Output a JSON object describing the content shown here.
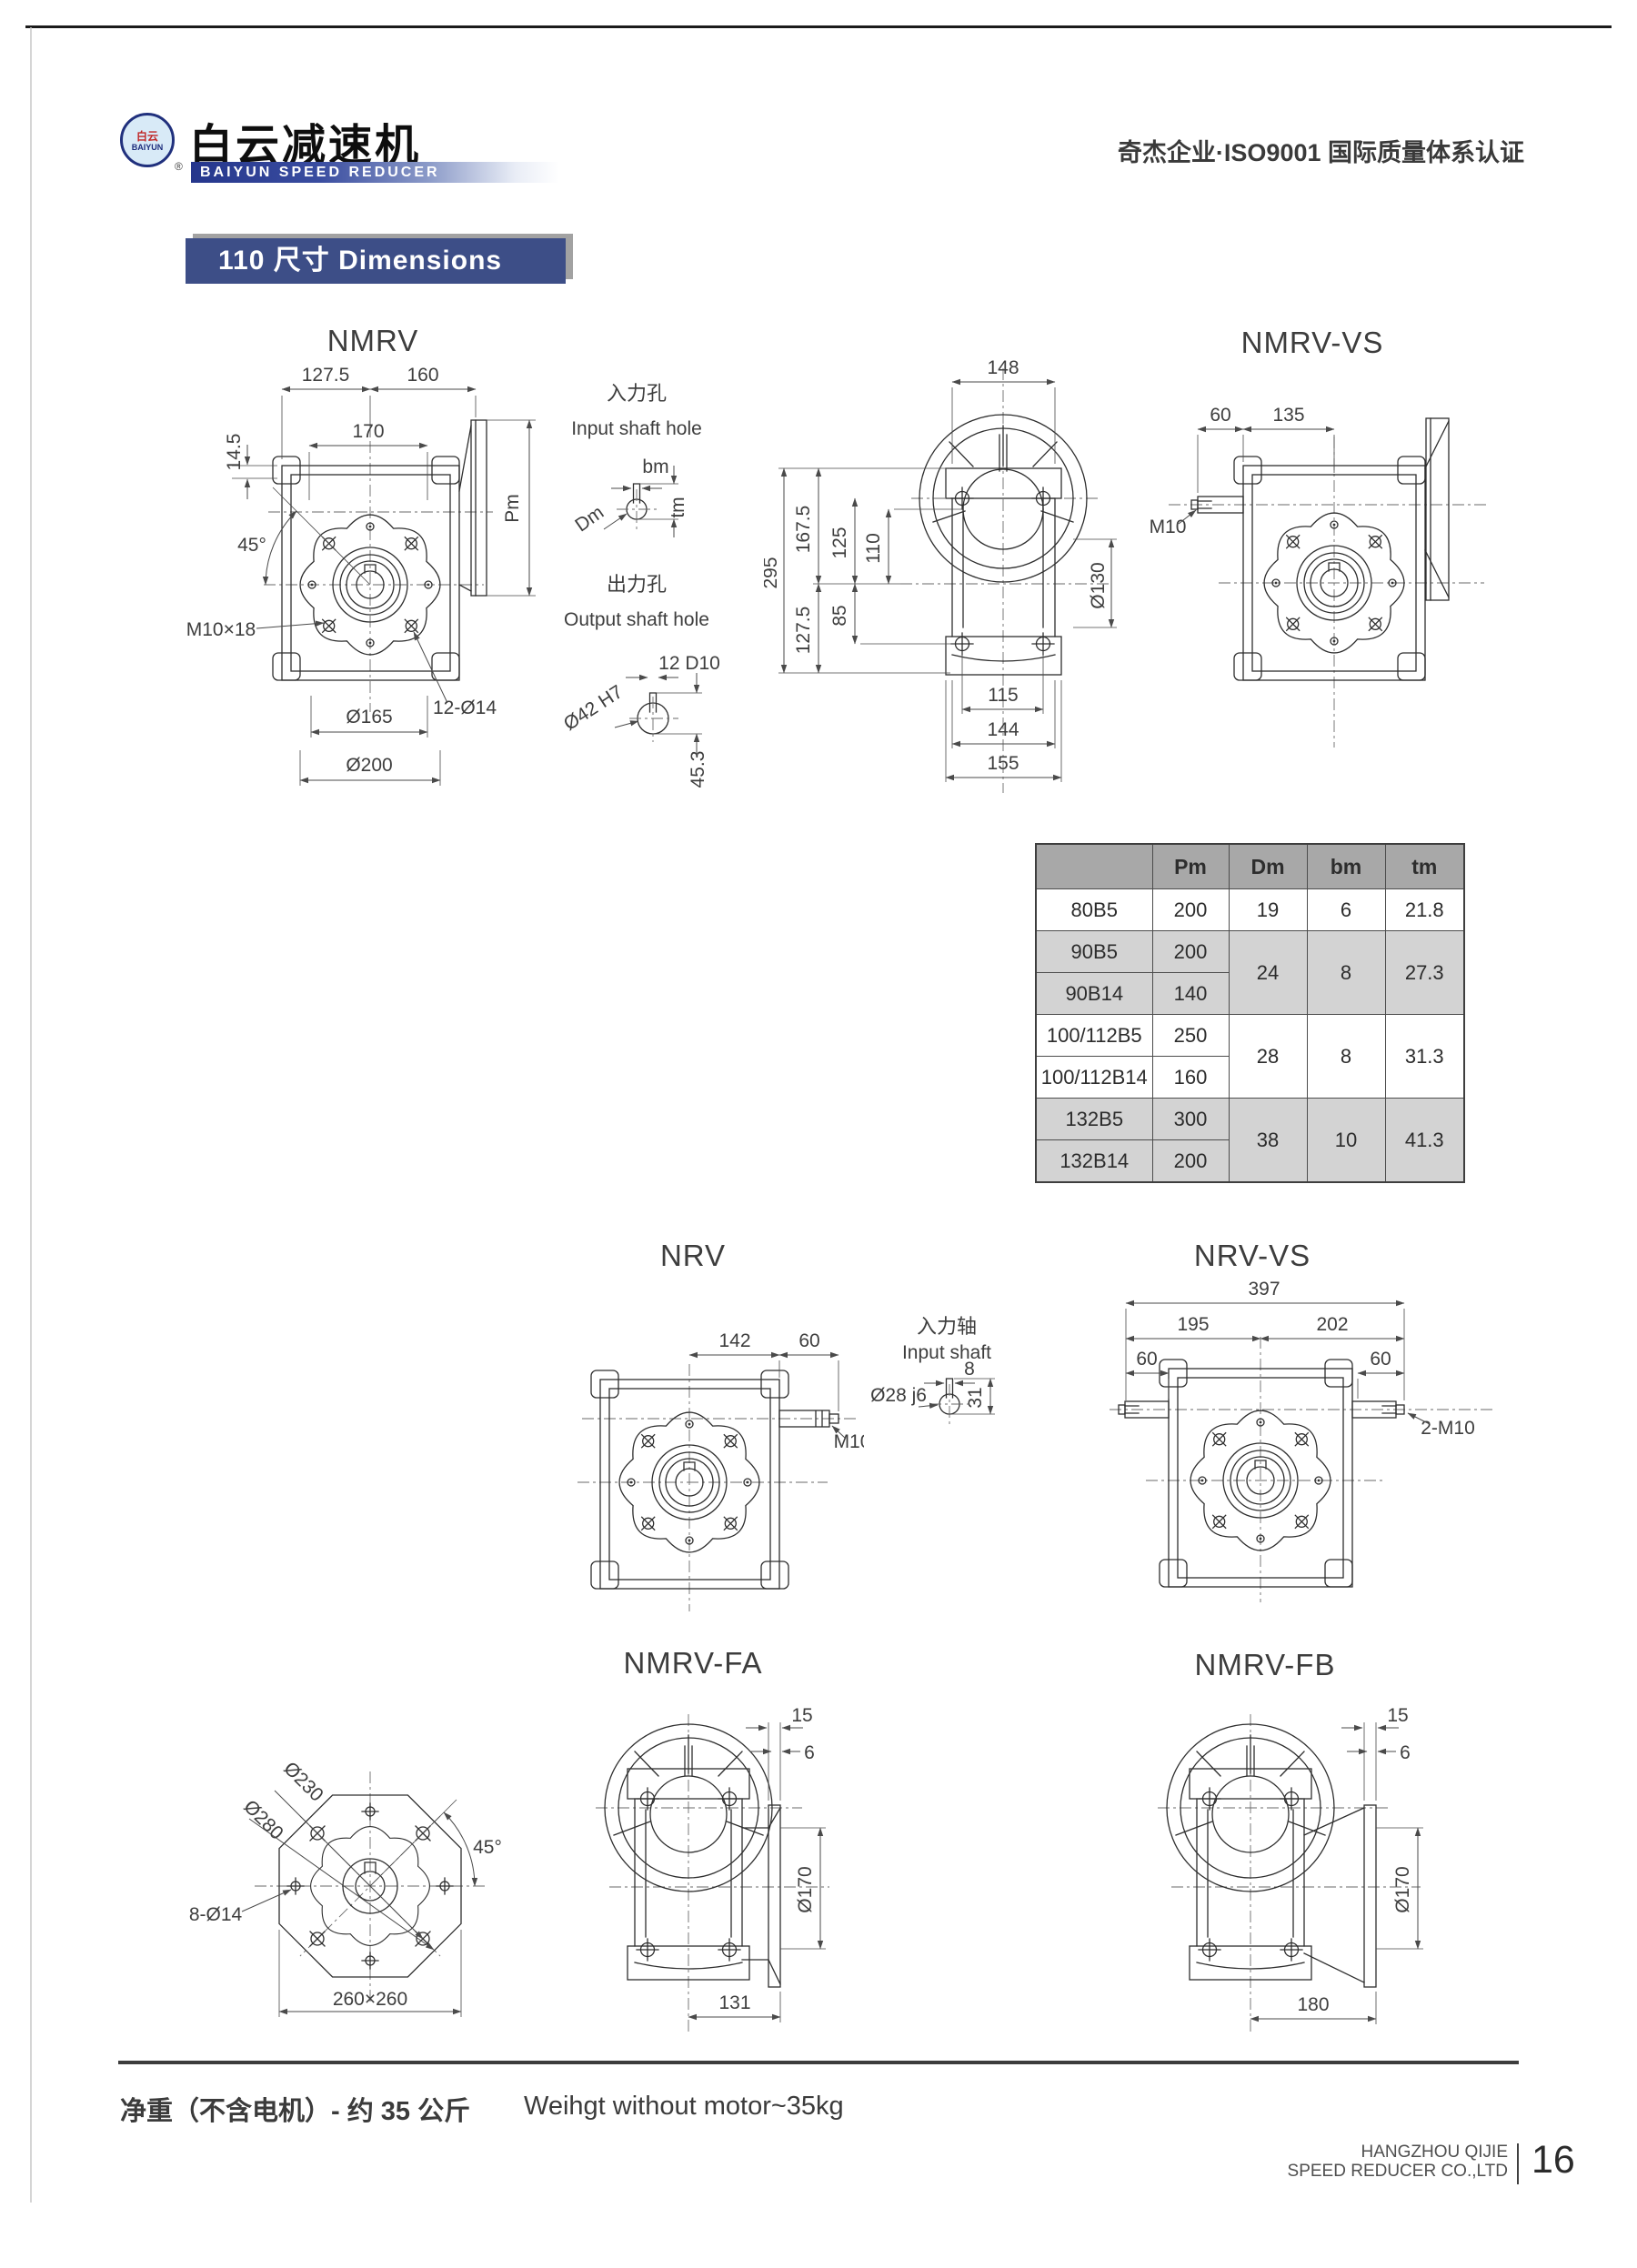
{
  "header": {
    "logo": {
      "emblem_line1": "白云",
      "emblem_line2": "BAIYUN",
      "brand_cn": "白云减速机",
      "brand_en": "BAIYUN SPEED REDUCER",
      "registered_mark": "®"
    },
    "certification": "奇杰企业·ISO9001 国际质量体系认证"
  },
  "section": {
    "title": "110 尺寸 Dimensions"
  },
  "figures": {
    "nmrv": {
      "title": "NMRV",
      "d1": "127.5",
      "d2": "160",
      "d3": "170",
      "d4": "14.5",
      "angle": "45°",
      "thread": "M10×18",
      "bolt_note": "12-Ø14",
      "dia1": "Ø165",
      "dia2": "Ø200",
      "pm": "Pm"
    },
    "input_hole": {
      "title_cn": "入力孔",
      "title_en": "Input shaft hole",
      "bm": "bm",
      "dm": "Dm",
      "tm": "tm"
    },
    "output_hole": {
      "title_cn": "出力孔",
      "title_en": "Output shaft hole",
      "key": "12 D10",
      "bore": "Ø42 H7",
      "depth": "45.3"
    },
    "nmrv_side": {
      "d148": "148",
      "d295": "295",
      "d167": "167.5",
      "d127": "127.5",
      "d125": "125",
      "d110": "110",
      "d85": "85",
      "dia130": "Ø130",
      "d115": "115",
      "d144": "144",
      "d155": "155"
    },
    "nmrv_vs": {
      "title": "NMRV-VS",
      "d60": "60",
      "d135": "135",
      "thread": "M10"
    },
    "nrv": {
      "title": "NRV",
      "d142": "142",
      "d60": "60",
      "thread": "M10"
    },
    "input_shaft": {
      "title_cn": "入力轴",
      "title_en": "Input shaft",
      "dia": "Ø28 j6",
      "d8": "8",
      "d31": "31"
    },
    "nrv_vs": {
      "title": "NRV-VS",
      "d397": "397",
      "d195": "195",
      "d202": "202",
      "d60l": "60",
      "d60r": "60",
      "thread": "2-M10"
    },
    "flange": {
      "dia230": "Ø230",
      "dia280": "Ø280",
      "angle": "45°",
      "holes": "8-Ø14",
      "square": "260×260"
    },
    "nmrv_fa": {
      "title": "NMRV-FA",
      "d15": "15",
      "d6": "6",
      "dia170": "Ø170",
      "d131": "131"
    },
    "nmrv_fb": {
      "title": "NMRV-FB",
      "d15": "15",
      "d6": "6",
      "dia170": "Ø170",
      "d180": "180"
    }
  },
  "table": {
    "headers": {
      "model": "",
      "pm": "Pm",
      "dm": "Dm",
      "bm": "bm",
      "tm": "tm"
    },
    "groups": [
      {
        "rows": [
          {
            "model": "80B5",
            "pm": "200"
          }
        ],
        "dm": "19",
        "bm": "6",
        "tm": "21.8"
      },
      {
        "rows": [
          {
            "model": "90B5",
            "pm": "200"
          },
          {
            "model": "90B14",
            "pm": "140"
          }
        ],
        "dm": "24",
        "bm": "8",
        "tm": "27.3"
      },
      {
        "rows": [
          {
            "model": "100/112B5",
            "pm": "250"
          },
          {
            "model": "100/112B14",
            "pm": "160"
          }
        ],
        "dm": "28",
        "bm": "8",
        "tm": "31.3"
      },
      {
        "rows": [
          {
            "model": "132B5",
            "pm": "300"
          },
          {
            "model": "132B14",
            "pm": "200"
          }
        ],
        "dm": "38",
        "bm": "10",
        "tm": "41.3"
      }
    ]
  },
  "footer": {
    "weight_cn": "净重（不含电机）- 约 35 公斤",
    "weight_en": "Weihgt without motor~35kg",
    "company_line1": "HANGZHOU QIJIE",
    "company_line2": "SPEED REDUCER CO.,LTD",
    "page_number": "16"
  },
  "colors": {
    "banner_blue": "#3d4e87",
    "table_header_gray": "#a8a8a8",
    "row_shade_gray": "#d3d3d3",
    "brand_blue": "#20307d"
  }
}
